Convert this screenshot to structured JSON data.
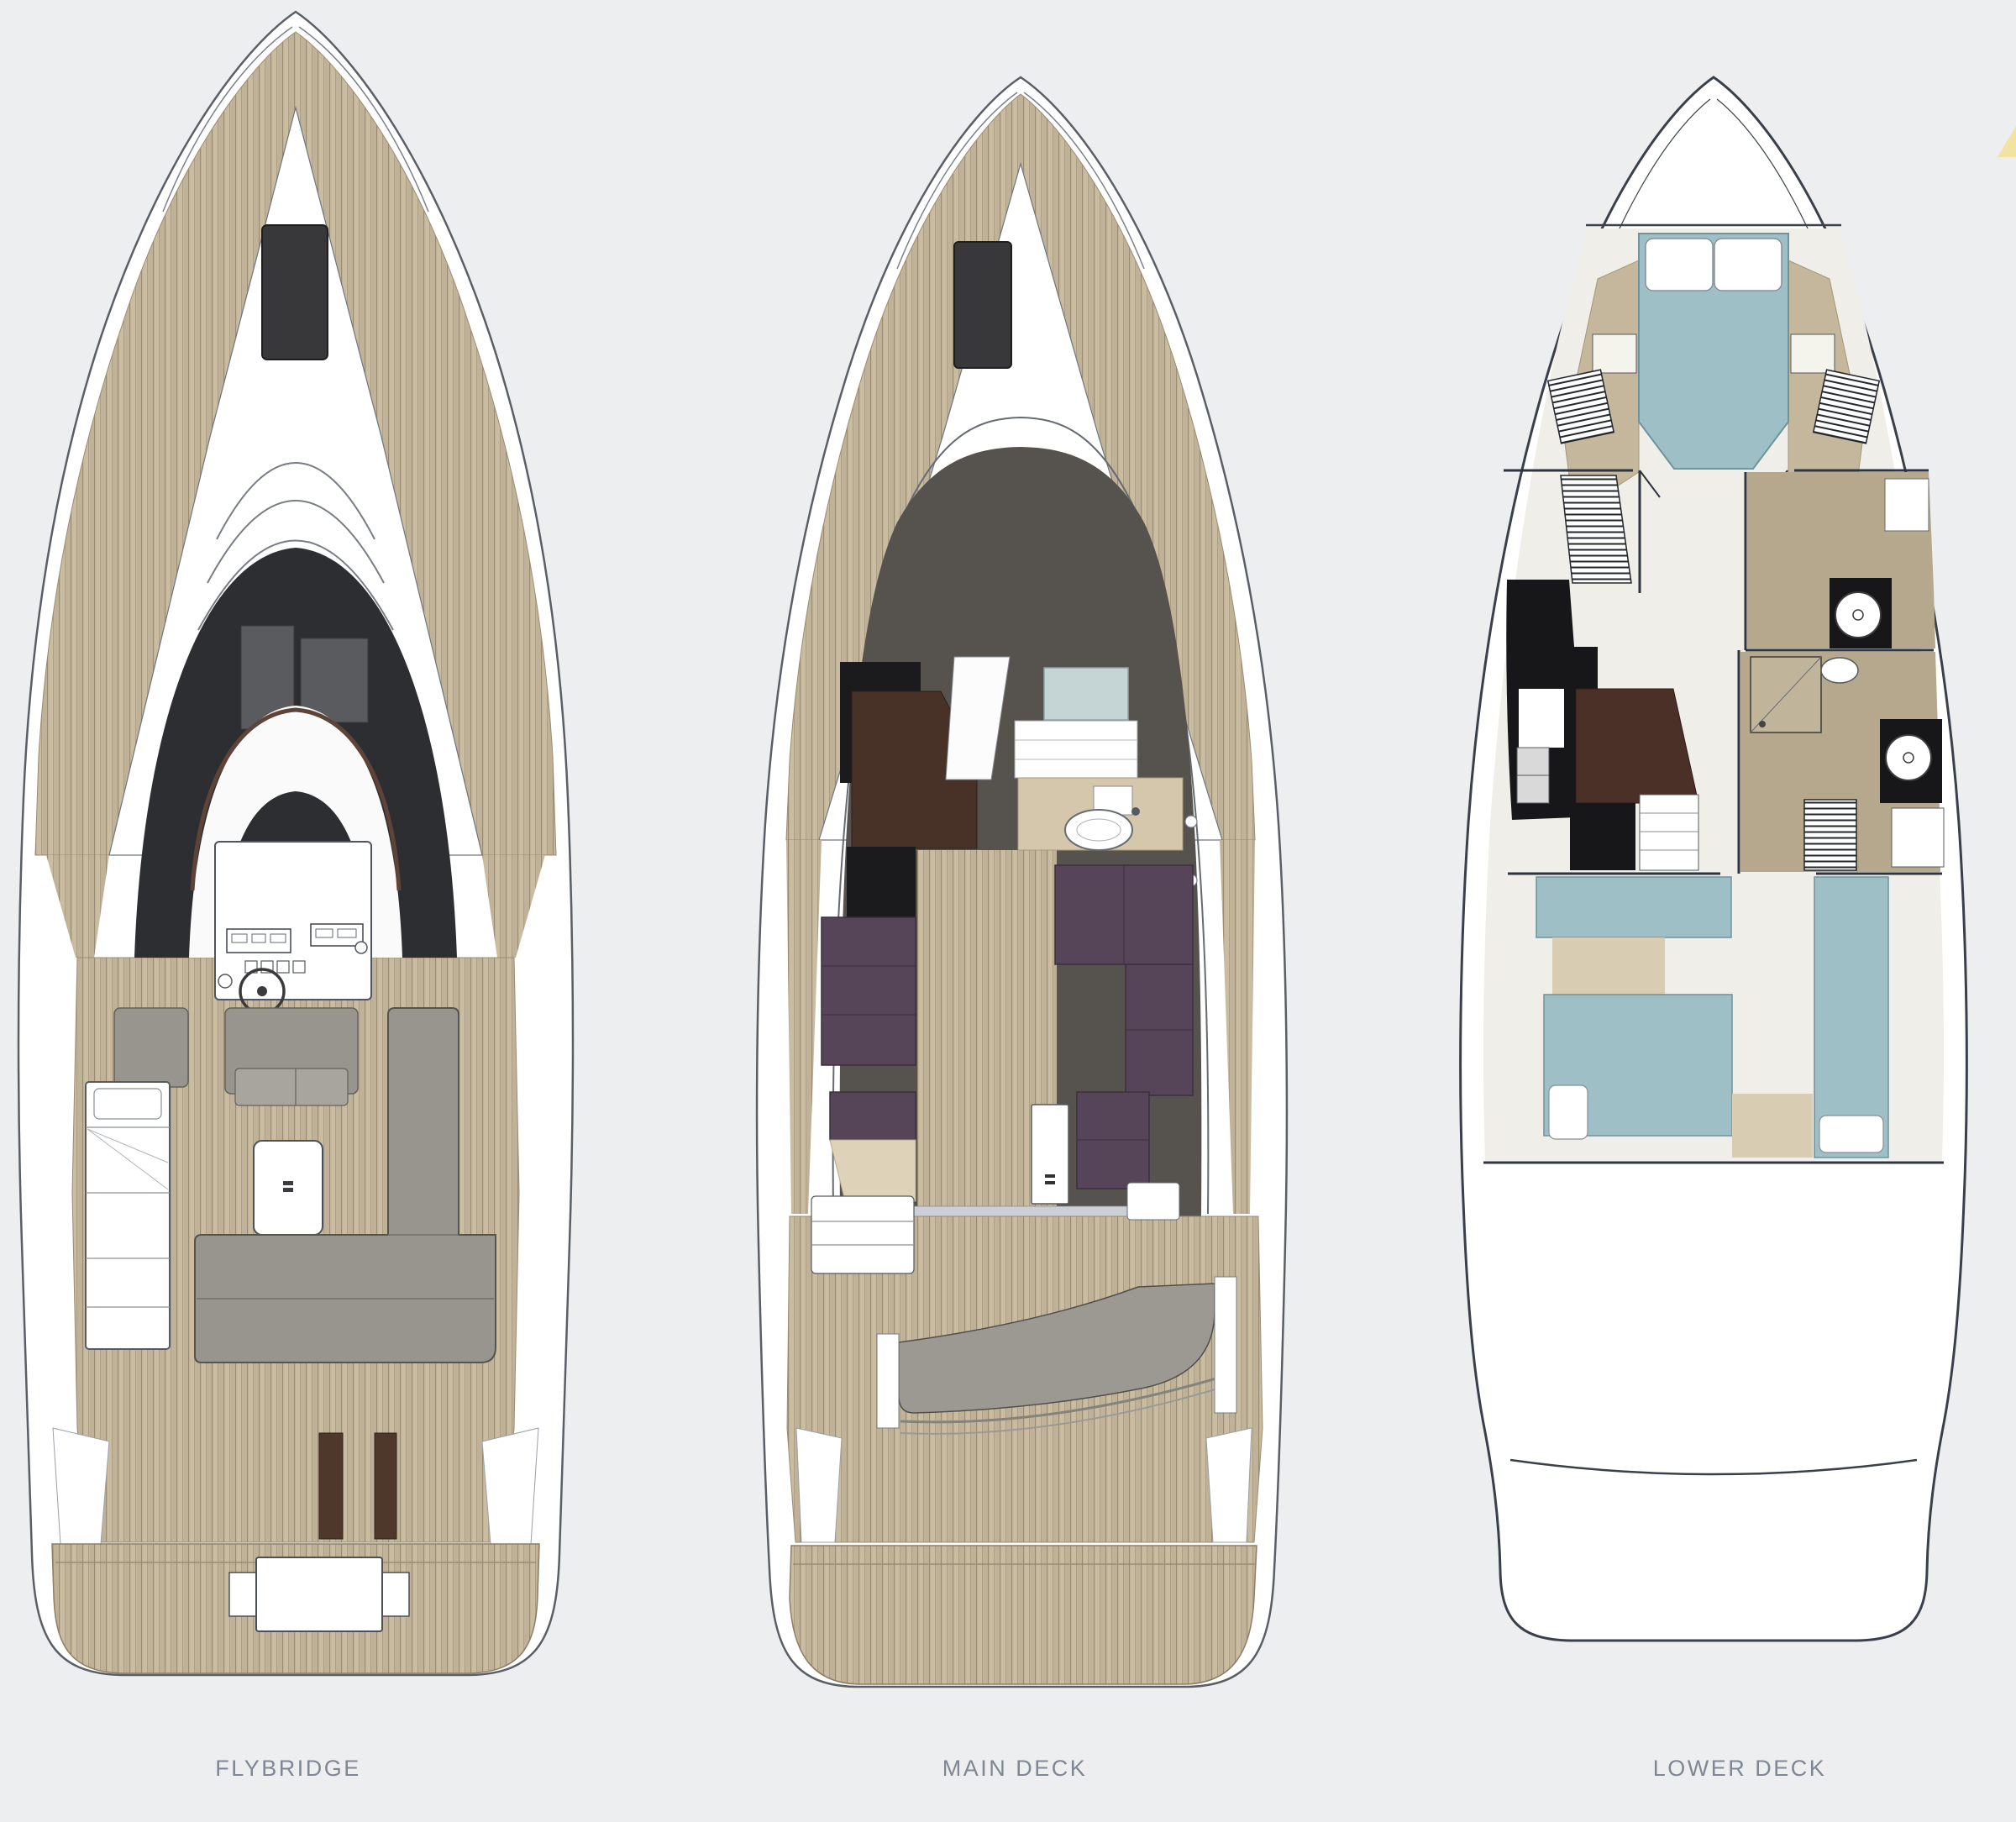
{
  "figure": {
    "type": "yacht-deck-plans",
    "deck_count": 3
  },
  "decks": [
    {
      "id": "flybridge",
      "label": "FLYBRIDGE"
    },
    {
      "id": "main-deck",
      "label": "MAIN DECK"
    },
    {
      "id": "lower-deck",
      "label": "LOWER DECK"
    }
  ],
  "palette": {
    "background": "#edeef0",
    "hull_white": "#ffffff",
    "hull_outline": "#5a5f66",
    "hull_outline_bold": "#39404a",
    "teak": "#c9bca1",
    "teak_line": "#9a8c72",
    "glass_dark": "#2d2e31",
    "salon_dark": "#56524d",
    "seat_gray": "#98958f",
    "sofa_purple": "#564459",
    "wood_brown": "#483227",
    "bed_blue": "#9fbfc6",
    "counter_beige": "#d4c7ac",
    "floor_cream": "#efeee8",
    "fixture_black": "#17171a",
    "label_text": "#7e8793",
    "accent_yellow": "#f3e3a0"
  }
}
